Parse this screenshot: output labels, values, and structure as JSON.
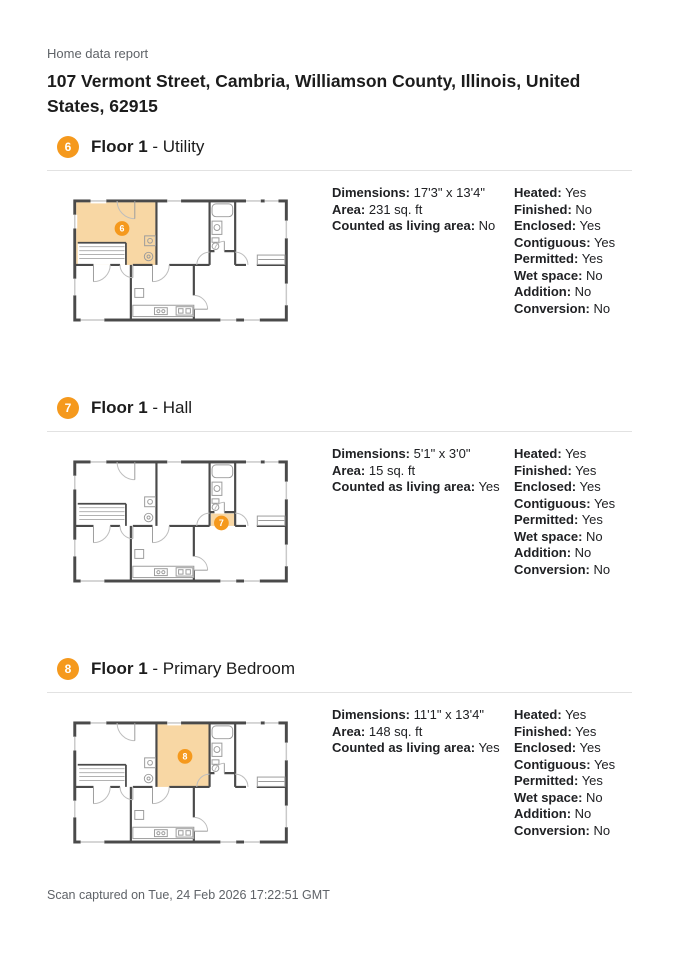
{
  "report": {
    "label": "Home data report",
    "address_line1": "107 Vermont Street, Cambria, Williamson County, Illinois, United",
    "address_line2": "States, 62915",
    "footer": "Scan captured on Tue, 24 Feb 2026 17:22:51 GMT"
  },
  "colors": {
    "accent": "#F5991D",
    "room_highlight": "#F8D7A4",
    "wall": "#4A4A4A",
    "divider": "#E2E2E2",
    "muted_text": "#5F6368"
  },
  "sections": [
    {
      "badge": "6",
      "title_bold": "Floor 1",
      "title_rest": " - Utility",
      "plan": {
        "highlight_room": "utility"
      },
      "details": [
        {
          "label": "Dimensions:",
          "value": "17'3\" x 13'4\""
        },
        {
          "label": "Area:",
          "value": "231 sq. ft"
        },
        {
          "label": "Counted as living area:",
          "value": "No"
        }
      ],
      "flags": [
        {
          "label": "Heated:",
          "value": "Yes"
        },
        {
          "label": "Finished:",
          "value": "No"
        },
        {
          "label": "Enclosed:",
          "value": "Yes"
        },
        {
          "label": "Contiguous:",
          "value": "Yes"
        },
        {
          "label": "Permitted:",
          "value": "Yes"
        },
        {
          "label": "Wet space:",
          "value": "No"
        },
        {
          "label": "Addition:",
          "value": "No"
        },
        {
          "label": "Conversion:",
          "value": "No"
        }
      ]
    },
    {
      "badge": "7",
      "title_bold": "Floor 1",
      "title_rest": " - Hall",
      "plan": {
        "highlight_room": "hall"
      },
      "details": [
        {
          "label": "Dimensions:",
          "value": "5'1\" x 3'0\""
        },
        {
          "label": "Area:",
          "value": "15 sq. ft"
        },
        {
          "label": "Counted as living area:",
          "value": "Yes"
        }
      ],
      "flags": [
        {
          "label": "Heated:",
          "value": "Yes"
        },
        {
          "label": "Finished:",
          "value": "Yes"
        },
        {
          "label": "Enclosed:",
          "value": "Yes"
        },
        {
          "label": "Contiguous:",
          "value": "Yes"
        },
        {
          "label": "Permitted:",
          "value": "Yes"
        },
        {
          "label": "Wet space:",
          "value": "No"
        },
        {
          "label": "Addition:",
          "value": "No"
        },
        {
          "label": "Conversion:",
          "value": "No"
        }
      ]
    },
    {
      "badge": "8",
      "title_bold": "Floor 1",
      "title_rest": " - Primary Bedroom",
      "plan": {
        "highlight_room": "primary_bedroom"
      },
      "details": [
        {
          "label": "Dimensions:",
          "value": "11'1\" x 13'4\""
        },
        {
          "label": "Area:",
          "value": "148 sq. ft"
        },
        {
          "label": "Counted as living area:",
          "value": "Yes"
        }
      ],
      "flags": [
        {
          "label": "Heated:",
          "value": "Yes"
        },
        {
          "label": "Finished:",
          "value": "Yes"
        },
        {
          "label": "Enclosed:",
          "value": "Yes"
        },
        {
          "label": "Contiguous:",
          "value": "Yes"
        },
        {
          "label": "Permitted:",
          "value": "Yes"
        },
        {
          "label": "Wet space:",
          "value": "No"
        },
        {
          "label": "Addition:",
          "value": "No"
        },
        {
          "label": "Conversion:",
          "value": "No"
        }
      ]
    }
  ]
}
